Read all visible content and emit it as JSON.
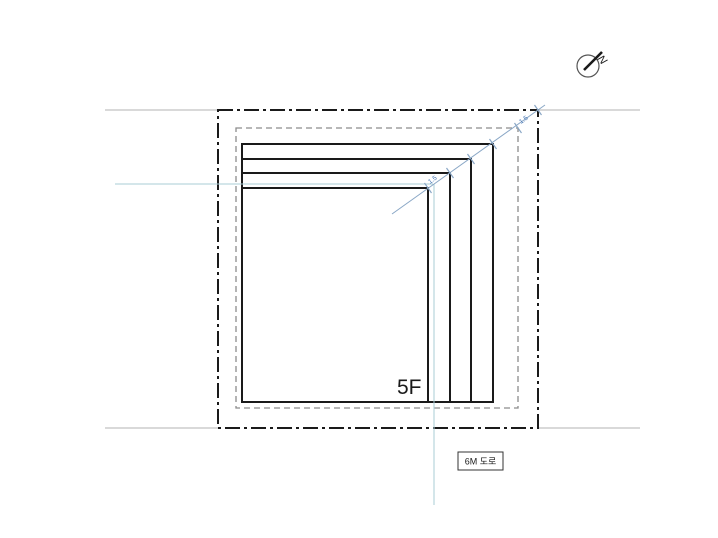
{
  "labels": {
    "floor": "5F",
    "road": "6M 도로",
    "north": "N"
  },
  "dimensions": {
    "upper": "1.5",
    "lower": "1.5"
  },
  "colors": {
    "line_black": "#1a1a1a",
    "dashed_gray": "#8c8c8c",
    "sight_gray": "#b3b3b3",
    "reference_blue": "#a9ccd6",
    "dimension_blue": "#8aa7c6",
    "dimension_text_blue": "#3a6db0"
  }
}
